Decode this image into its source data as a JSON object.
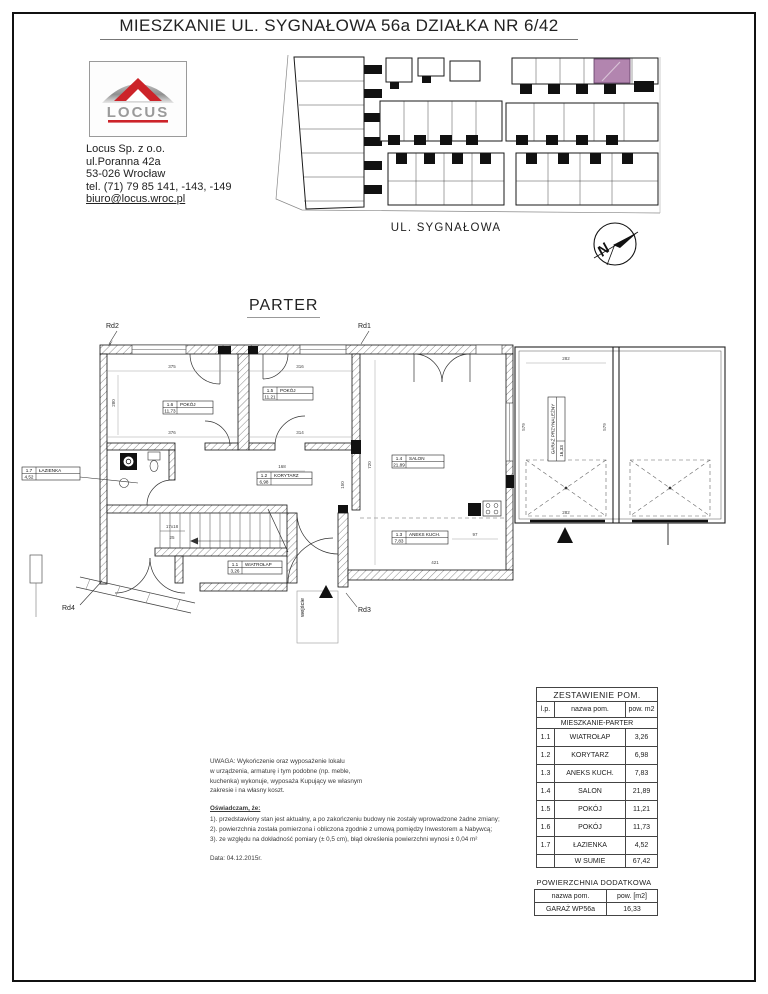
{
  "page": {
    "title": "MIESZKANIE UL. SYGNAŁOWA 56a DZIAŁKA NR 6/42"
  },
  "company": {
    "logo_text": "LOCUS",
    "name": "Locus Sp. z o.o.",
    "street": "ul.Poranna 42a",
    "city": "53-026 Wrocław",
    "phone": "tel. (71) 79 85 141, -143, -149",
    "email": "biuro@locus.wroc.pl",
    "brand_red": "#cc2329",
    "logo_gray": "#9a9a9a"
  },
  "site_plan": {
    "street_label": "UL. SYGNAŁOWA",
    "highlight_color": "#b285af",
    "north_letter": "N"
  },
  "floor_plan": {
    "title": "PARTER",
    "entrance_label": "wejście",
    "markers": {
      "rd1": "Rd1",
      "rd2": "Rd2",
      "rd3": "Rd3",
      "rd4": "Rd4"
    },
    "stairs": {
      "steps": "17x18",
      "width": "25"
    },
    "rooms": {
      "wiatrolap": {
        "id": "1.1",
        "name": "WIATROŁAP",
        "area": "3,26"
      },
      "korytarz": {
        "id": "1.2",
        "name": "KORYTARZ",
        "area": "6,98"
      },
      "aneks": {
        "id": "1.3",
        "name": "ANEKS KUCH.",
        "area": "7,83"
      },
      "salon": {
        "id": "1.4",
        "name": "SALON",
        "area": "21,89"
      },
      "pokoj5": {
        "id": "1.5",
        "name": "POKÓJ",
        "area": "11,21"
      },
      "pokoj6": {
        "id": "1.6",
        "name": "POKÓJ",
        "area": "11,73"
      },
      "lazienka": {
        "id": "1.7",
        "name": "ŁAZIENKA",
        "area": "4,52"
      }
    },
    "garage": {
      "area": "16,33",
      "name": "GARAŻ PRZYNALEŻNY"
    },
    "dimensions": {
      "top_left": "375",
      "top_mid": "316",
      "left": "280",
      "room6_w": "376",
      "room5_w": "314",
      "hall": "168",
      "salon_h": "720",
      "hall_h": "150",
      "garage_top": "282",
      "garage_left": "579",
      "garage_right": "579",
      "garage_bottom": "282",
      "kitchen_w": "97",
      "kitchen_bottom": "421"
    }
  },
  "notes": {
    "uwaga_lines": [
      "UWAGA: Wykończenie oraz wyposażenie lokalu",
      "w urządzenia, armaturę i tym podobne (np. meble,",
      "kuchenka) wykonuje, wyposaża Kupujący we własnym",
      "zakresie i na własny koszt."
    ],
    "declaration_title": "Oświadczam, że:",
    "declaration_lines": [
      "1). przedstawiony stan jest aktualny, a po zakończeniu budowy nie zostały wprowadzone żadne zmiany;",
      "2). powierzchnia została pomierzona i obliczona zgodnie z umową pomiędzy Inwestorem a Nabywcą;",
      "3). ze względu na dokładność pomiary (± 0,5 cm), błąd określenia powierzchni wynosi ± 0,04 m²"
    ],
    "date": "Data: 04.12.2015r."
  },
  "summary_table": {
    "title": "ZESTAWIENIE POM.",
    "col_lp": "l.p.",
    "col_name": "nazwa pom.",
    "col_area": "pow. m2",
    "section": "MIESZKANIE-PARTER",
    "rows": [
      {
        "id": "1.1",
        "name": "WIATROŁAP",
        "area": "3,26"
      },
      {
        "id": "1.2",
        "name": "KORYTARZ",
        "area": "6,98"
      },
      {
        "id": "1.3",
        "name": "ANEKS KUCH.",
        "area": "7,83"
      },
      {
        "id": "1.4",
        "name": "SALON",
        "area": "21,89"
      },
      {
        "id": "1.5",
        "name": "POKÓJ",
        "area": "11,21"
      },
      {
        "id": "1.6",
        "name": "POKÓJ",
        "area": "11,73"
      },
      {
        "id": "1.7",
        "name": "ŁAZIENKA",
        "area": "4,52"
      }
    ],
    "total_label": "W SUMIE",
    "total_value": "67,42"
  },
  "additional_table": {
    "title": "POWIERZCHNIA DODATKOWA",
    "col_name": "nazwa pom.",
    "col_area": "pow. [m2]",
    "row_name": "GARAŻ WP56a",
    "row_area": "16,33"
  }
}
